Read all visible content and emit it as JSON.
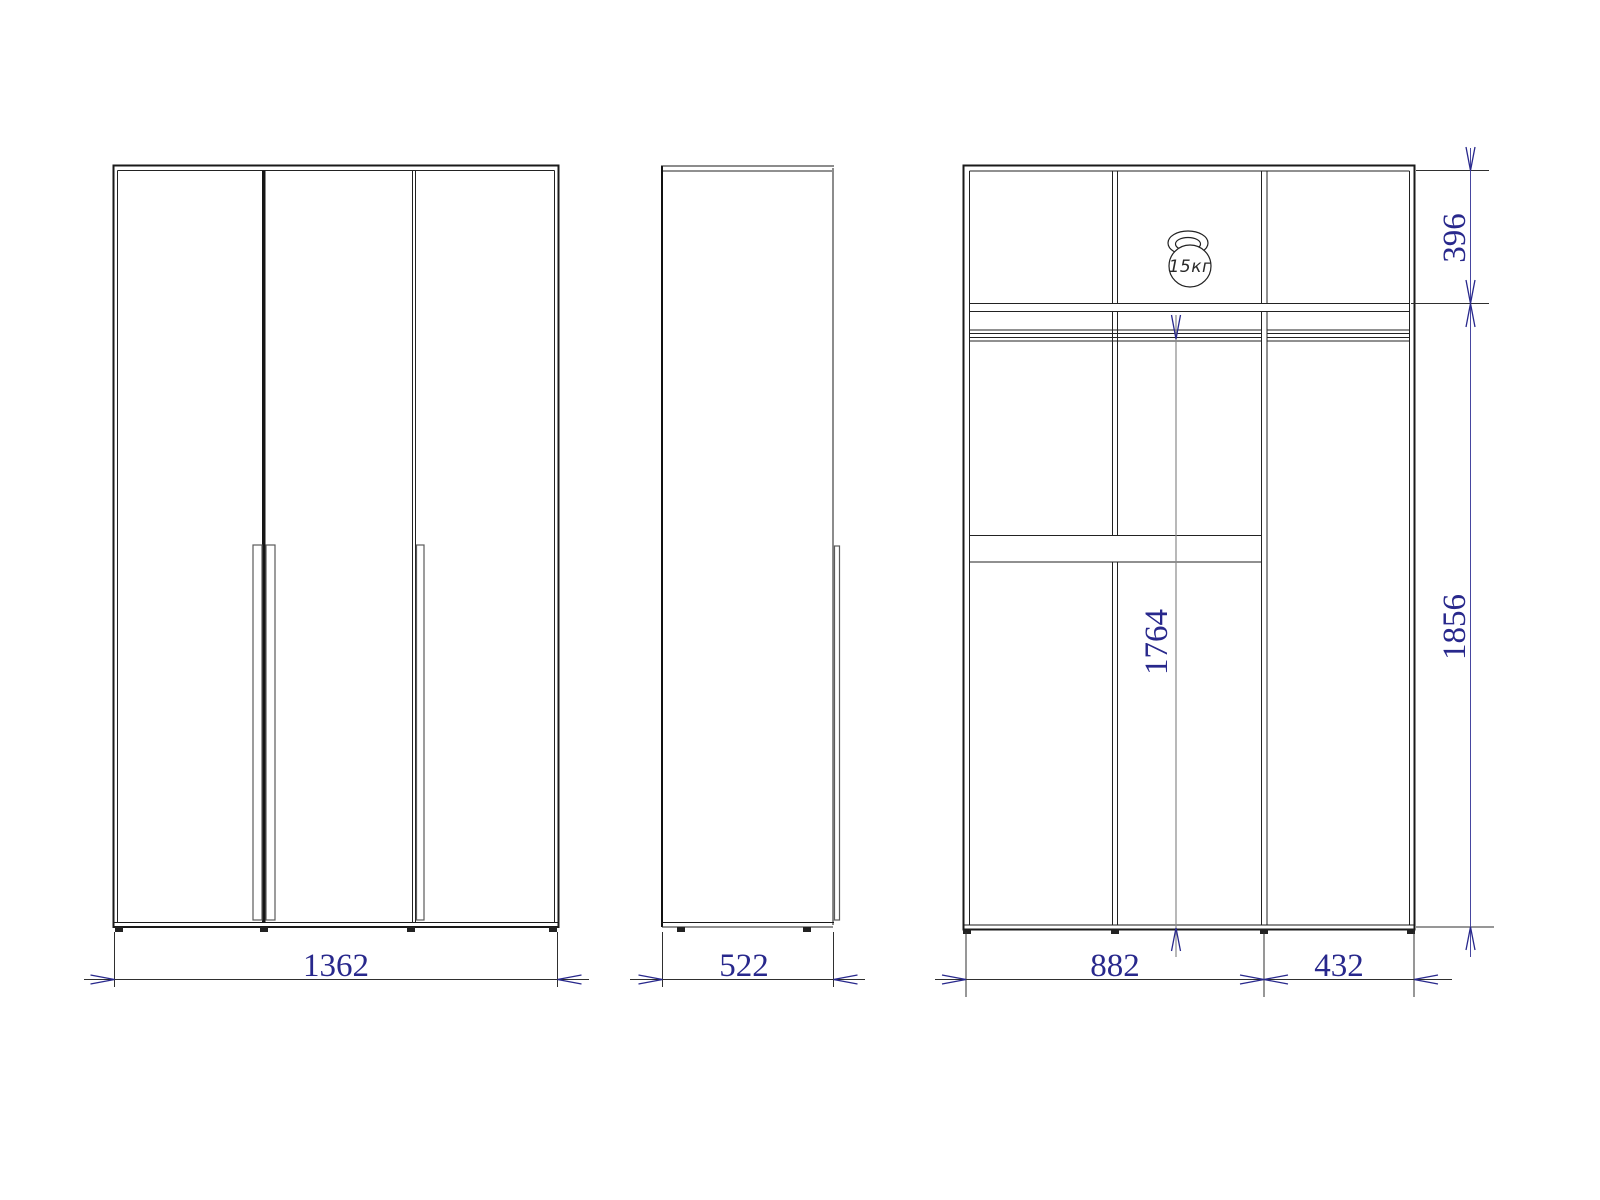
{
  "drawing_type": "wardrobe-technical-drawing",
  "dims": {
    "front_width": "1362",
    "side_depth": "522",
    "left_section_width": "882",
    "right_section_width": "432",
    "top_section_height": "396",
    "rod_to_floor_height": "1764",
    "interior_height": "1856"
  },
  "weight": {
    "max_load": "15кг"
  },
  "icons": {
    "weight_icon": "kettlebell-weight-icon"
  },
  "colors": {
    "dimension_text": "#28288C",
    "dimension_arrow": "#28288C",
    "outline": "#1a1a1a",
    "auxiliary_gray": "#8a8a8a",
    "background": "#ffffff"
  }
}
